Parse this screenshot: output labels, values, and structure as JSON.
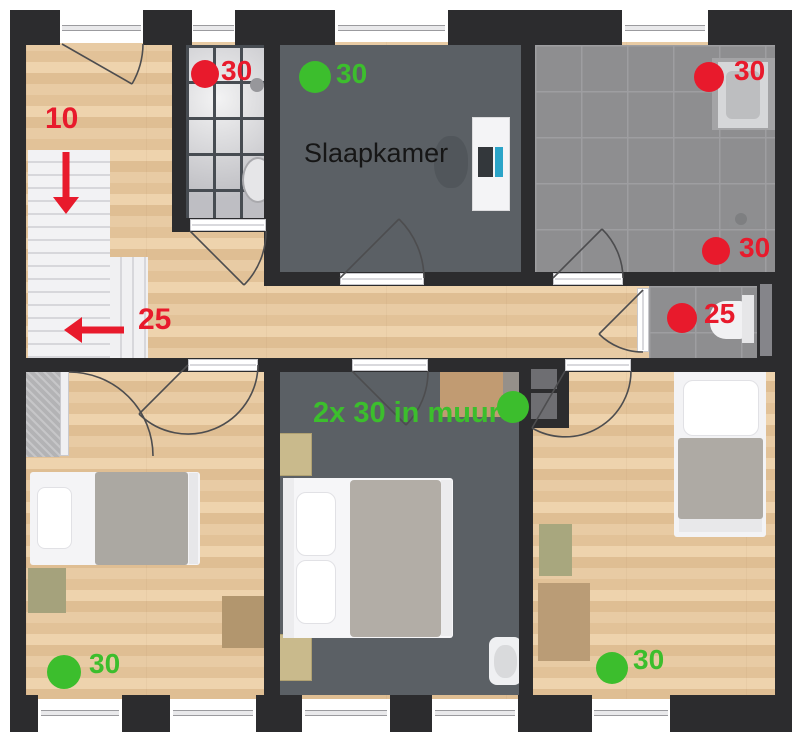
{
  "room_label": "Slaapkamer",
  "wall_note": "2x 30 in muur",
  "stairs_note": "10",
  "hall_note": "25",
  "markers": {
    "shower": "30",
    "bedroom_top": "30",
    "bathroom_right": "30",
    "bathroom_shower": "30",
    "toilet": "25",
    "bedroom_left": "30",
    "bedroom_right": "30"
  },
  "colors": {
    "annotation_red": "#e81a2c",
    "annotation_green": "#3cbe2d",
    "wall": "#2c2c2e",
    "wood_floor": "#e5c69d",
    "dark_floor": "#5b6065",
    "tile_floor": "#8e8e90"
  }
}
